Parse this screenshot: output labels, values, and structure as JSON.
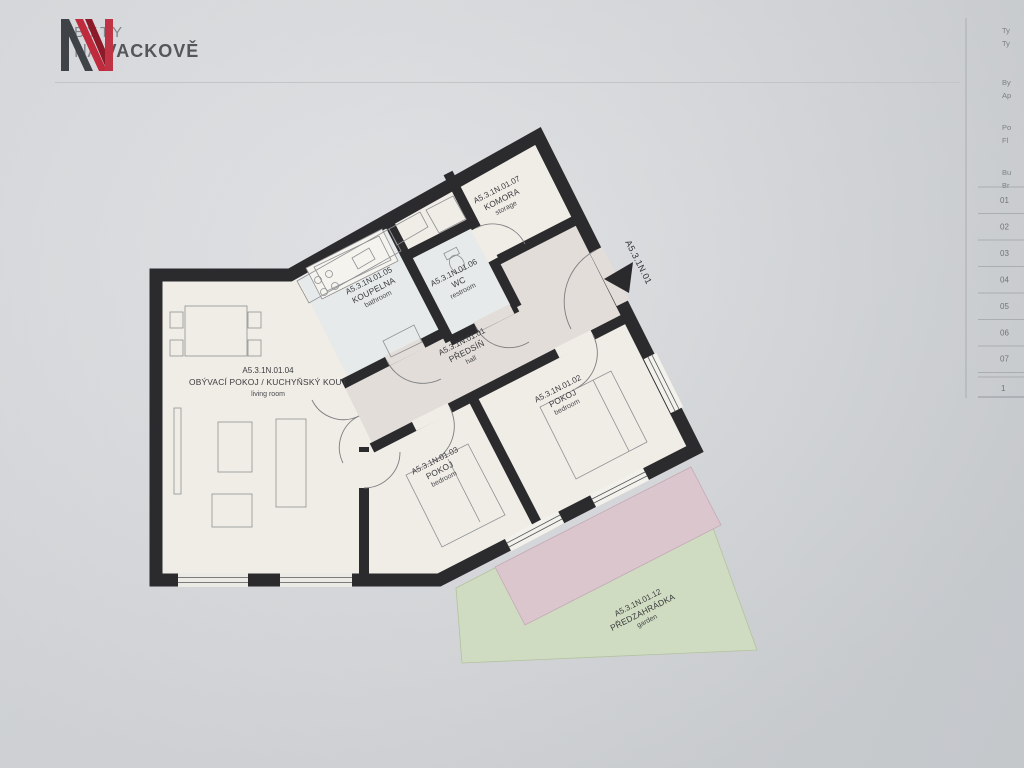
{
  "header": {
    "brand_line1": "BYTY",
    "brand_line2_prefix": "NA",
    "brand_line2_bold": "VACKOVĚ"
  },
  "plan": {
    "entrance_code": "A5.3.1N.01",
    "rooms": [
      {
        "code": "A5.3.1N.01.01",
        "name": "PŘEDSÍŇ",
        "name_en": "hall"
      },
      {
        "code": "A5.3.1N.01.02",
        "name": "POKOJ",
        "name_en": "bedroom"
      },
      {
        "code": "A5.3.1N.01.03",
        "name": "POKOJ",
        "name_en": "bedroom"
      },
      {
        "code": "A5.3.1N.01.04",
        "name": "OBÝVACÍ POKOJ / KUCHYŇSKÝ KOUT",
        "name_en": "living room"
      },
      {
        "code": "A5.3.1N.01.05",
        "name": "KOUPELNA",
        "name_en": "bathroom"
      },
      {
        "code": "A5.3.1N.01.06",
        "name": "WC",
        "name_en": "restroom"
      },
      {
        "code": "A5.3.1N.01.07",
        "name": "KOMORA",
        "name_en": "storage"
      },
      {
        "code": "A5.3.1N.01.12",
        "name": "PŘEDZAHRÁDKA",
        "name_en": "garden"
      }
    ],
    "colors": {
      "wall": "#2b2b2e",
      "floor": "#f0ede7",
      "hall_floor": "#e2ddd9",
      "wet_floor": "#e7eaea",
      "terrace": "#dbc6ce",
      "garden": "#cfdcc1",
      "brand_red": "#bf2b3c"
    }
  },
  "side_panel": {
    "fields": [
      {
        "line1": "Ty",
        "line2": "Ty"
      },
      {
        "line1": "By",
        "line2": "Ap"
      },
      {
        "line1": "Po",
        "line2": "Fl"
      },
      {
        "line1": "Bu",
        "line2": "Br"
      }
    ],
    "rows": [
      "01",
      "02",
      "03",
      "04",
      "05",
      "06",
      "07"
    ],
    "total": "1"
  }
}
